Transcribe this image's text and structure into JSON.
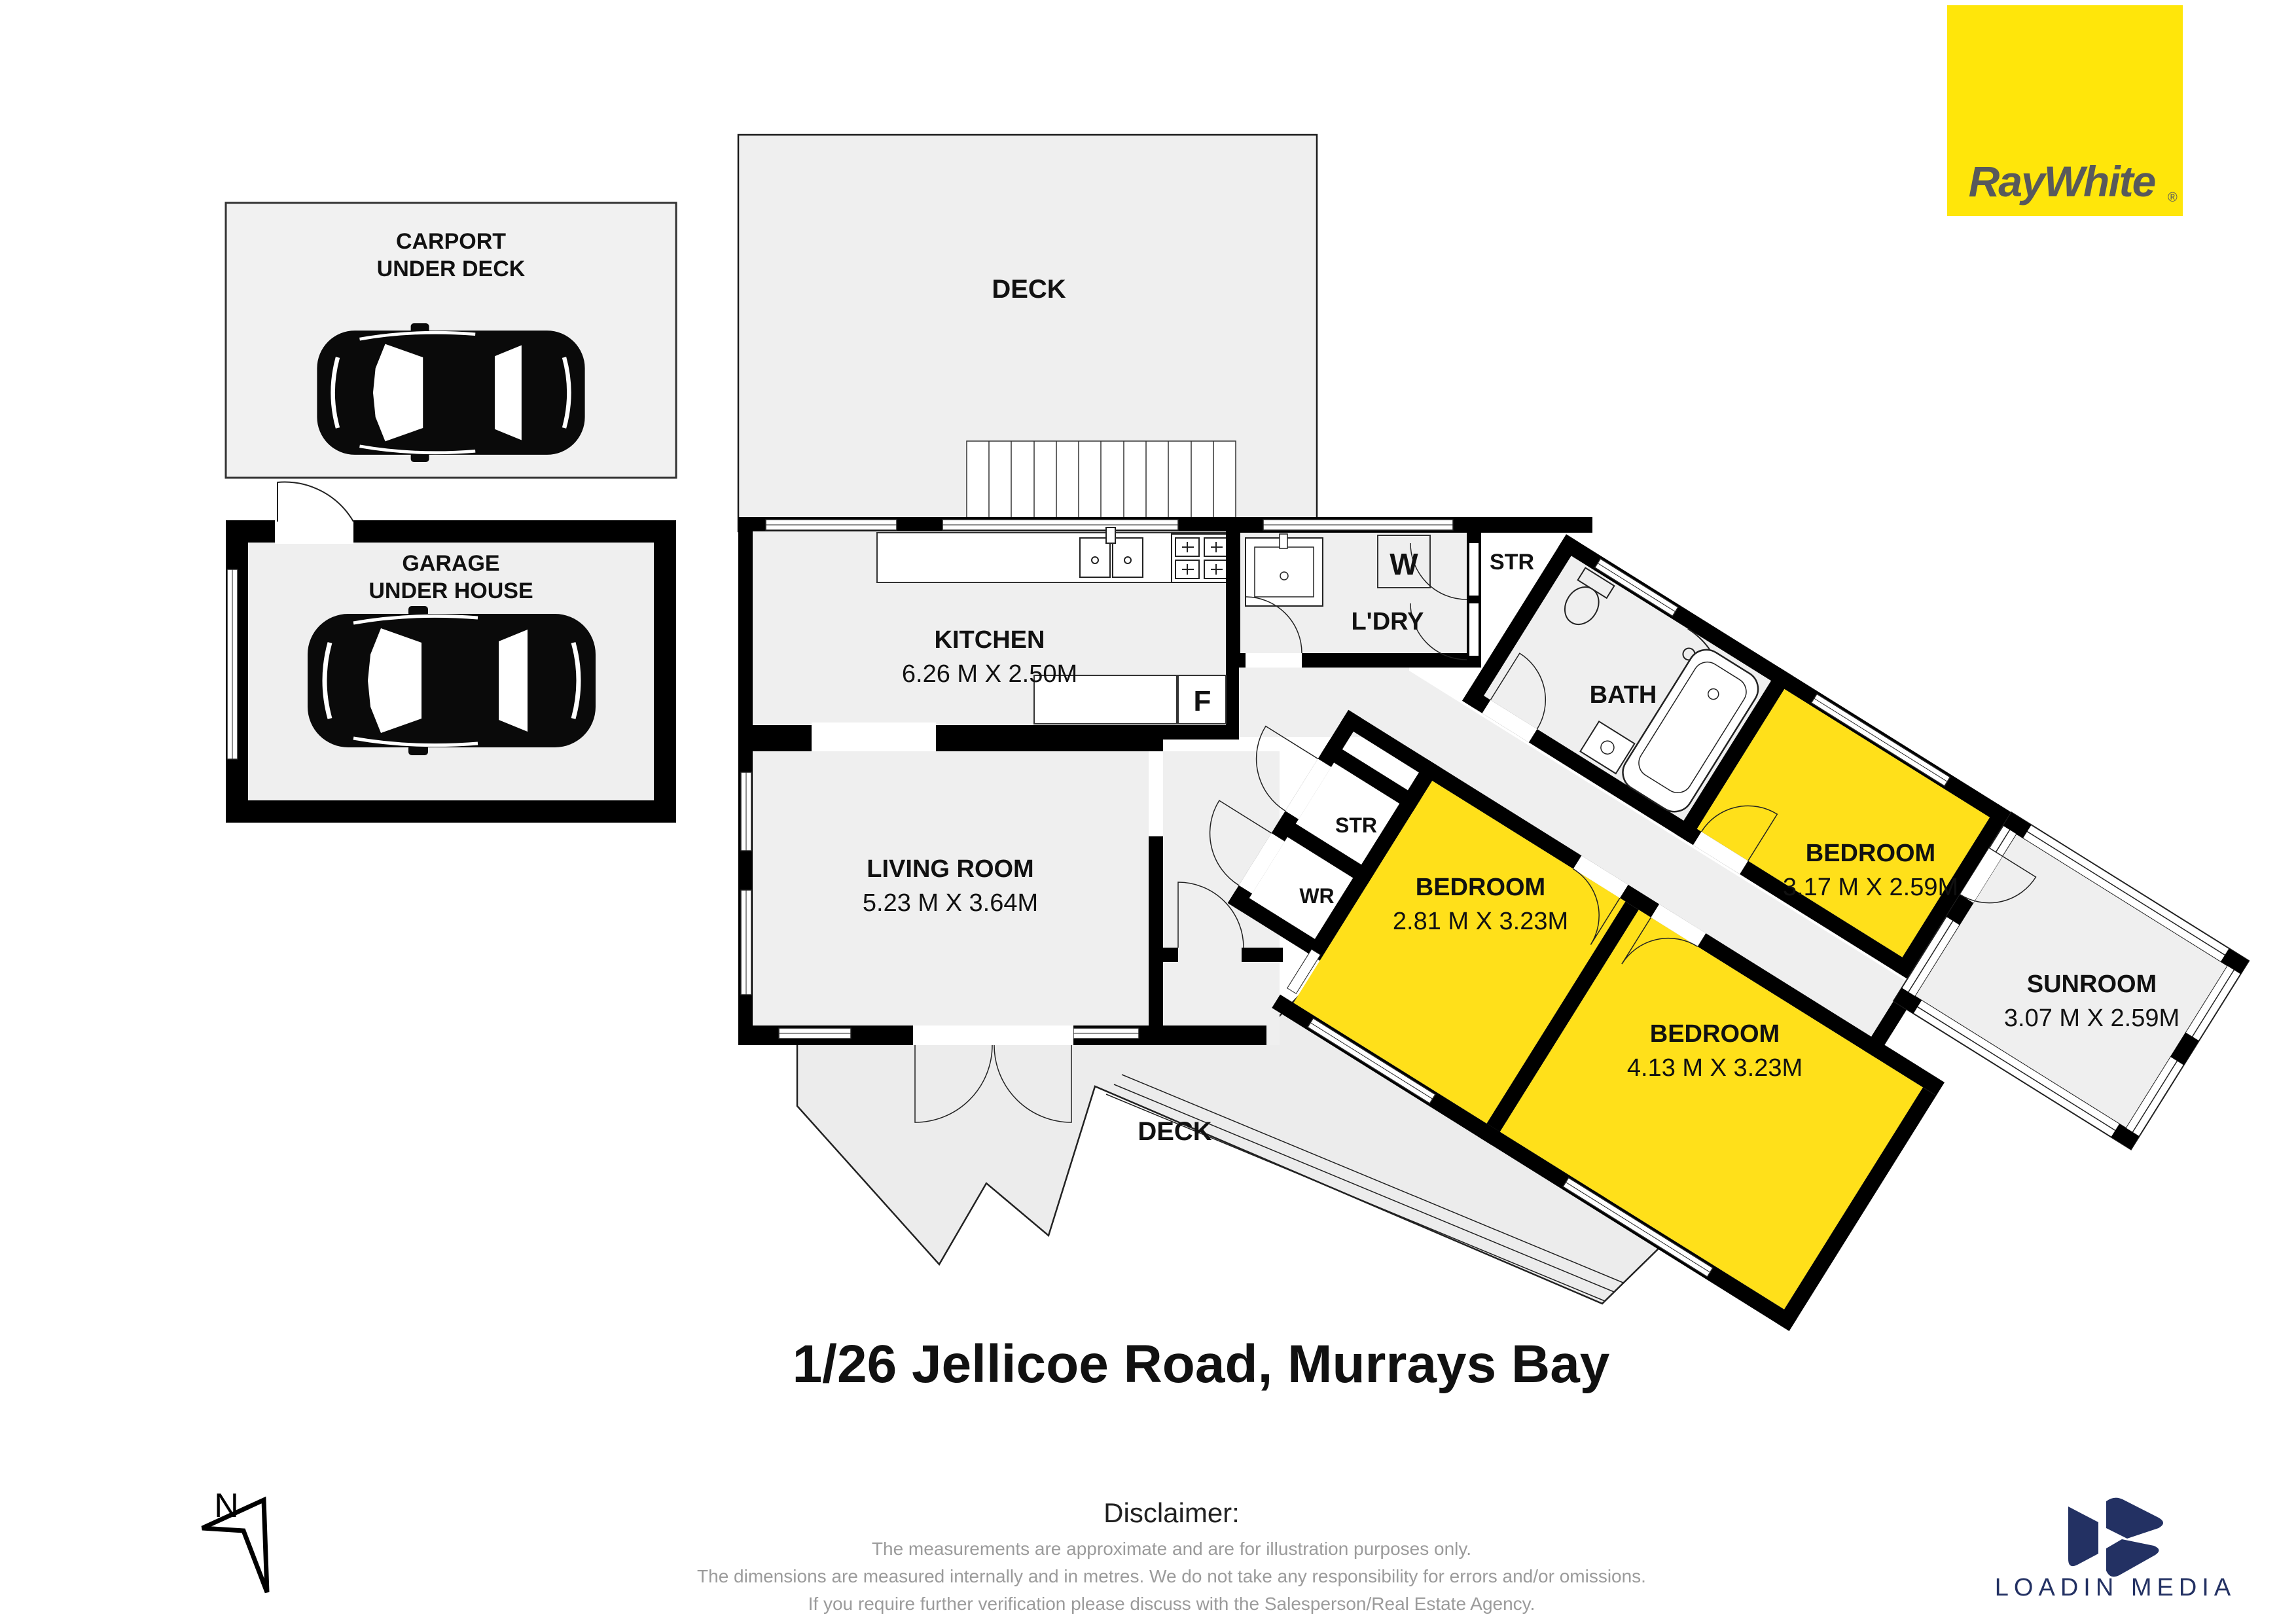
{
  "title": "1/26 Jellicoe Road, Murrays Bay",
  "branding": {
    "raywhite_logo": "RayWhite",
    "raywhite_reg": "®",
    "loadin_media": "LOADIN MEDIA"
  },
  "compass": {
    "north": "N"
  },
  "rooms": {
    "carport": {
      "line1": "CARPORT",
      "line2": "UNDER DECK"
    },
    "garage": {
      "line1": "GARAGE",
      "line2": "UNDER HOUSE"
    },
    "deck_top": "DECK",
    "deck_bottom": "DECK",
    "kitchen": {
      "name": "KITCHEN",
      "dims": "6.26 M X 2.50M"
    },
    "living": {
      "name": "LIVING ROOM",
      "dims": "5.23 M X 3.64M"
    },
    "laundry": "L'DRY",
    "bath": "BATH",
    "bedroom1": {
      "name": "BEDROOM",
      "dims": "2.81 M X 3.23M"
    },
    "bedroom2": {
      "name": "BEDROOM",
      "dims": "4.13 M X 3.23M"
    },
    "bedroom3": {
      "name": "BEDROOM",
      "dims": "3.17 M X 2.59M"
    },
    "sunroom": {
      "name": "SUNROOM",
      "dims": "3.07 M X 2.59M"
    },
    "str_hall": "STR",
    "str_wing": "STR",
    "wr": "WR",
    "washer": "W",
    "fridge": "F"
  },
  "disclaimer": {
    "heading": "Disclaimer:",
    "line1": "The measurements are approximate and are for illustration purposes only.",
    "line2": "The dimensions are measured internally and in metres. We do not take any responsibility for errors and/or omissions.",
    "line3": "If you require further verification please discuss with the Salesperson/Real Estate Agency."
  },
  "colors": {
    "room_yellow": "#FFE01A",
    "logo_yellow": "#FFE60A",
    "room_gray": "#EFEFEF",
    "wall_black": "#000000",
    "navy": "#233163",
    "disclaimer_gray": "#9B9B9B"
  }
}
